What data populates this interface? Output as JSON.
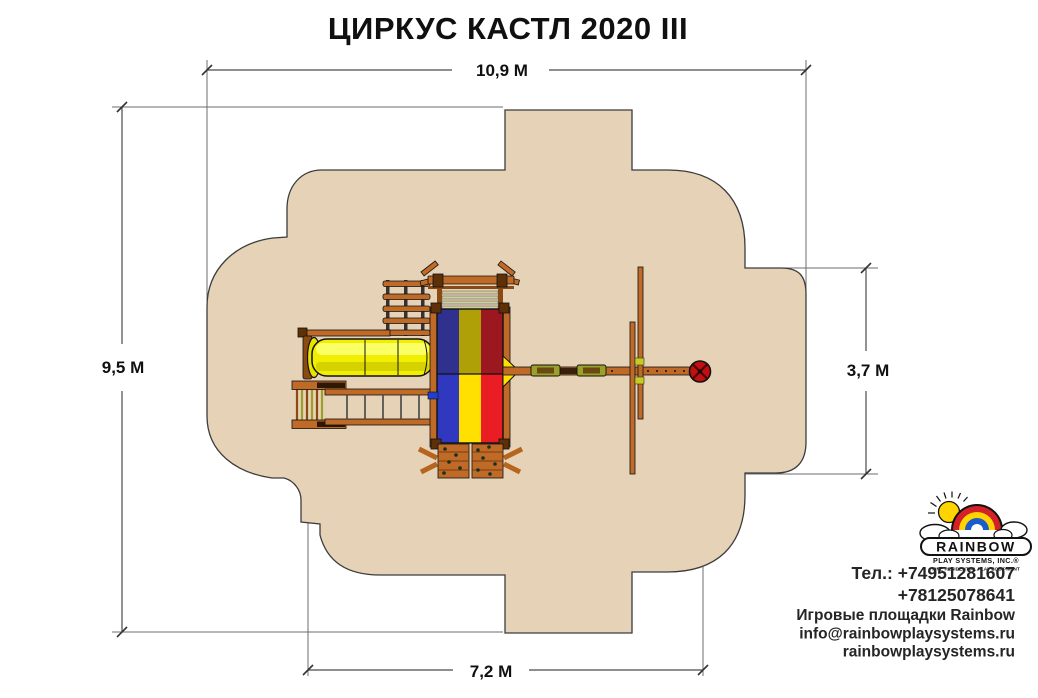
{
  "title": "ЦИРКУС КАСТЛ 2020 III",
  "dimensions": {
    "top": "10,9 М",
    "left": "9,5 М",
    "right": "3,7 М",
    "bottom": "7,2 М"
  },
  "logo": {
    "brand": "RAINBOW",
    "subtitle": "PLAY SYSTEMS, INC.®",
    "tagline": "FINE RESIDENTIAL PLAY EQUIPMENT"
  },
  "contacts": {
    "phone_line1": "Тел.: +74951281607",
    "phone_line2": "+78125078641",
    "company_line": "Игровые площадки Rainbow",
    "email": "info@rainbowplaysystems.ru",
    "website": "rainbowplaysystems.ru"
  },
  "colors": {
    "play_area_fill": "#e6d2b6",
    "play_area_outline": "#3c3c3c",
    "wood": "#c06a28",
    "wood_dark": "#5e3008",
    "slide_yellow": "#f2ee00",
    "canopy_top_stripes": [
      "#30308e",
      "#b0a008",
      "#9c1820"
    ],
    "canopy_bottom_stripes": [
      "#3038c0",
      "#ffe000",
      "#ea1c24"
    ],
    "swing_seat_green": "#9aa02a",
    "tire_swing_red": "#c21010",
    "rainbow_red": "#d42027",
    "rainbow_yellow": "#ffd400",
    "rainbow_blue": "#1b5cc8",
    "sun_yellow": "#ffd400"
  }
}
